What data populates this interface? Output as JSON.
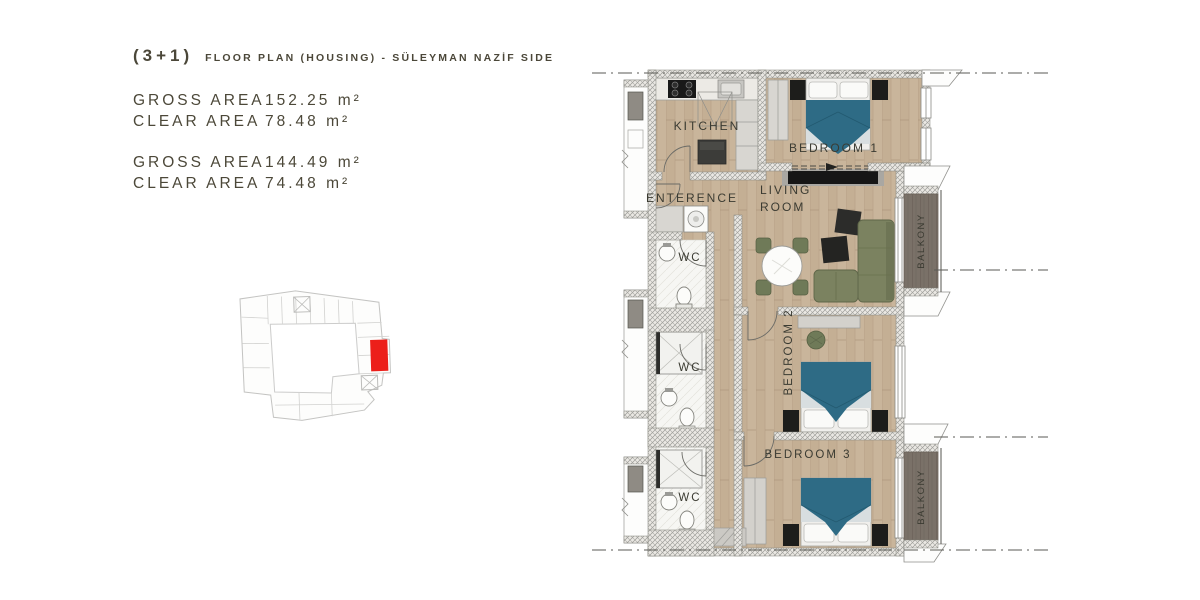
{
  "header": {
    "unit_type": "(3+1)",
    "title": "FLOOR PLAN (HOUSING) - SÜLEYMAN NAZİF SIDE"
  },
  "area_table": {
    "groups": [
      {
        "rows": [
          {
            "label": "GROSS AREA",
            "value": "152.25 m²"
          },
          {
            "label": "CLEAR AREA",
            "value": "78.48 m²"
          }
        ]
      },
      {
        "rows": [
          {
            "label": "GROSS AREA",
            "value": "144.49 m²"
          },
          {
            "label": "CLEAR AREA",
            "value": "74.48 m²"
          }
        ]
      }
    ]
  },
  "key_plan": {
    "description": "building footprint mini map with highlighted unit",
    "highlight_color": "#ec1f1a"
  },
  "floor_plan": {
    "labels": {
      "kitchen": "KITCHEN",
      "bedroom1": "BEDROOM 1",
      "enterence": "ENTERENCE",
      "living_line1": "LIVING",
      "living_line2": "ROOM",
      "wc": "WC",
      "bedroom2": "BEDROOM 2",
      "bedroom3": "BEDROOM 3",
      "balkony": "BALKONY"
    }
  },
  "colors": {
    "text": "#4b4739",
    "wood_floor": "#c9b59b",
    "wall_hatch": "#eae8e3",
    "duvet_teal": "#2e6b85",
    "sofa_green": "#7b8260",
    "balcony_deck": "#7a7168",
    "highlight_red": "#ec1f1a"
  }
}
